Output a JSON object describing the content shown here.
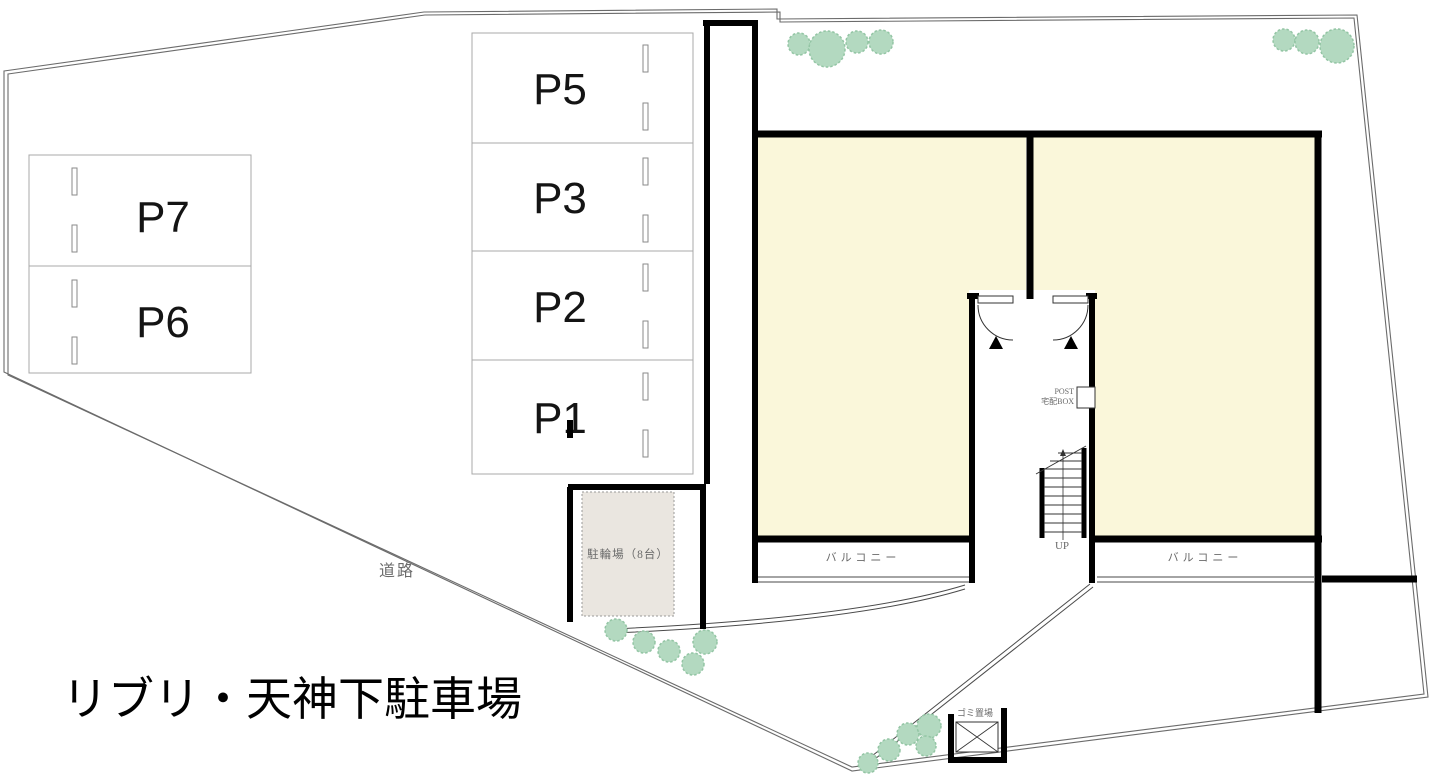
{
  "title": "リブリ・天神下駐車場",
  "labels": {
    "road": "道路",
    "bicycle_parking": "駐輪場（8台）",
    "balcony": "バルコニー",
    "garbage": "ゴミ置場",
    "stairs_up": "UP",
    "post_line1": "POST",
    "post_line2": "宅配BOX"
  },
  "parking": {
    "left_spaces": [
      {
        "label": "P7"
      },
      {
        "label": "P6"
      }
    ],
    "center_spaces": [
      {
        "label": "P5"
      },
      {
        "label": "P3"
      },
      {
        "label": "P2"
      },
      {
        "label": "P1"
      }
    ]
  },
  "colors": {
    "room_fill": "#faf7da",
    "tree_fill": "#b3d9c0",
    "bicycle_area_fill": "#eae6e0",
    "wall": "#000000",
    "boundary_line": "#6b6b6b"
  }
}
